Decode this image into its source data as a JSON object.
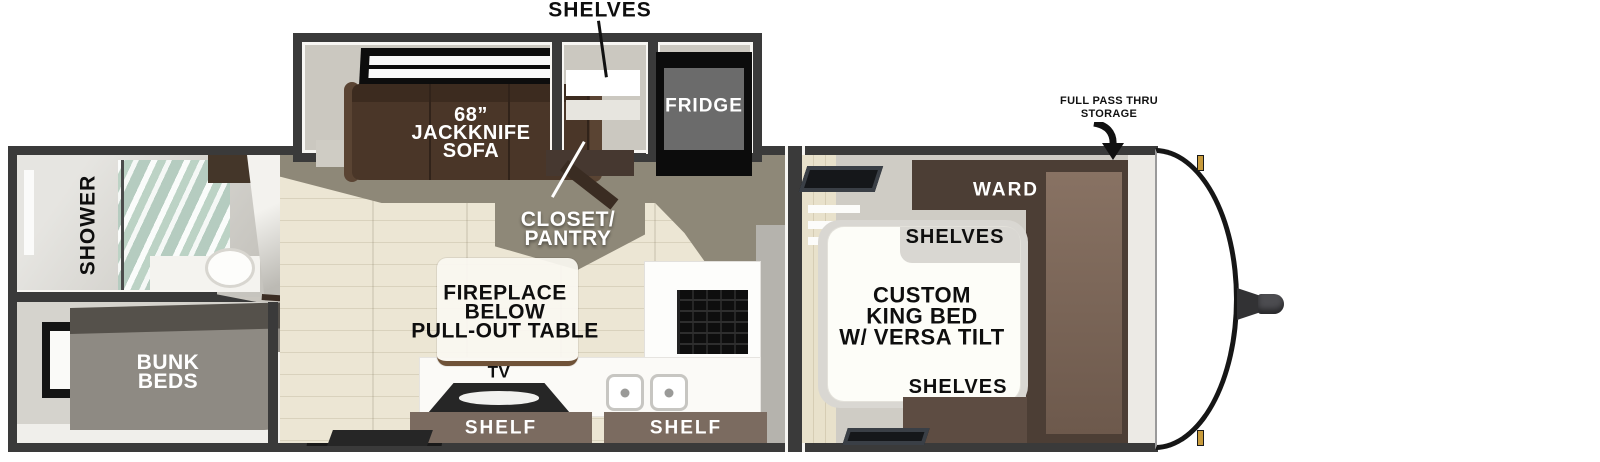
{
  "colors": {
    "wall": "#3a3a3a",
    "floor_wood": "#e9e3d1",
    "walkway": "#8e8878",
    "sofa_brown": "#4a3628",
    "ward_brown": "#4c3e35",
    "shelf_brown": "#7b6b60",
    "body_white": "#ffffff",
    "clip_gold": "#c89b3c"
  },
  "callouts": {
    "shelves": "SHELVES",
    "storage": [
      "FULL PASS THRU",
      "STORAGE"
    ]
  },
  "slideout": {
    "sofa": [
      "68”",
      "JACKKNIFE",
      "SOFA"
    ],
    "fridge": "FRIDGE"
  },
  "bathroom": {
    "shower": "SHOWER"
  },
  "bunkroom": {
    "bunks": [
      "BUNK",
      "BEDS"
    ]
  },
  "kitchen": {
    "closet": [
      "CLOSET/",
      "PANTRY"
    ],
    "table": [
      "FIREPLACE",
      "BELOW",
      "PULL-OUT TABLE"
    ],
    "tv": "TV",
    "shelf_left": "SHELF",
    "shelf_right": "SHELF"
  },
  "bedroom": {
    "ward": "WARD",
    "shelves_top": "SHELVES",
    "bed": [
      "CUSTOM",
      "KING BED",
      "W/ VERSA TILT"
    ],
    "shelves_bottom": "SHELVES"
  }
}
